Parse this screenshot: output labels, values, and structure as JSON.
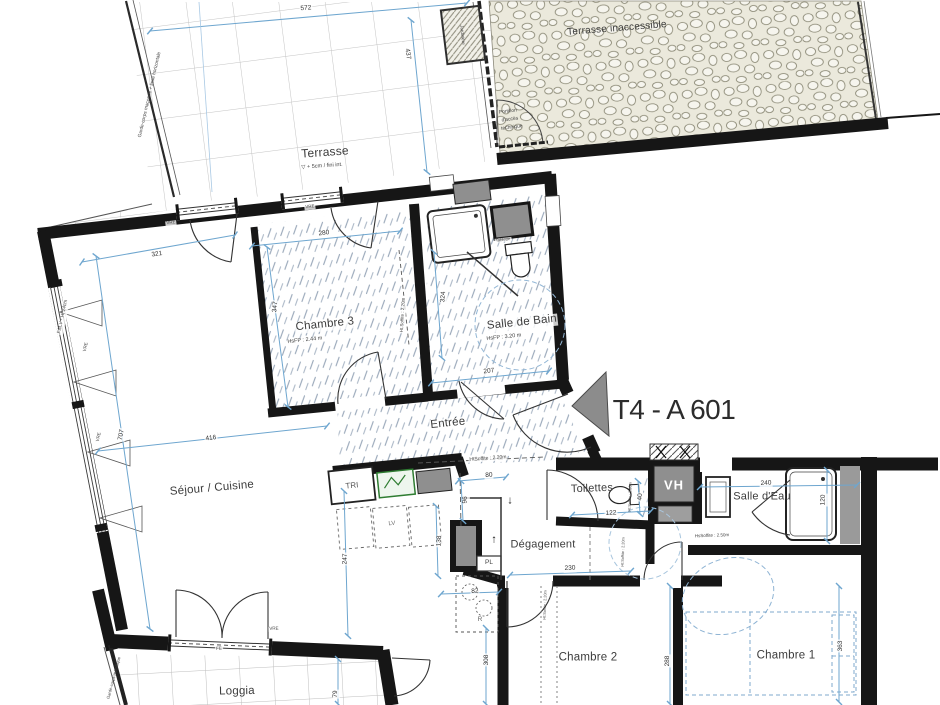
{
  "unit": {
    "label": "T4 - A 601"
  },
  "rooms": {
    "terrasse": {
      "name": "Terrasse",
      "note": "▽ + 5cm / fini int."
    },
    "terrasse_inaccessible": {
      "name": "Terrasse inaccessible"
    },
    "chambre3": {
      "name": "Chambre 3",
      "height_note": "HsFP : 2.44 m"
    },
    "salle_de_bain": {
      "name": "Salle de Bain",
      "height_note": "HsFP : 3.20 m"
    },
    "entree": {
      "name": "Entrée"
    },
    "sejour": {
      "name": "Séjour / Cuisine"
    },
    "toilettes": {
      "name": "Toilettes"
    },
    "salle_eau": {
      "name": "Salle d'Eau"
    },
    "degagement": {
      "name": "Dégagement"
    },
    "chambre2": {
      "name": "Chambre 2"
    },
    "chambre1": {
      "name": "Chambre 1"
    },
    "loggia": {
      "name": "Loggia"
    }
  },
  "annotations": {
    "garde_corps_terrasse": "Garde-corps maçonné + lisse horizontale",
    "garde_corps_loggia": "Garde-corps métallique",
    "jardiniere": "Jardinière",
    "portillon_l1": "Portillon",
    "portillon_l2": "d'accès",
    "portillon_l3": "technique",
    "fmv": "F.M.V - Ht 24cm",
    "tablette": "Tablette",
    "vre": "VRE",
    "fe": "FE",
    "tri": "TRI",
    "vh": "VH",
    "pl": "PL",
    "r": "R",
    "lv": "LV",
    "arrow_up": "↑",
    "arrow_down": "↓",
    "soffite_entree": "HtSoffite : 2.20m",
    "soffite_chambre3": "Ht.Soffite : 2.20m",
    "soffite_toilettes": "Ht:Soffite : 2.20m",
    "soffite_degagement": "Ht:Soffite : 2.20m",
    "soffite_chambre2": "Ht:Soffite : 2.20m",
    "soffite_sde": "HsSoffite : 2.50m"
  },
  "dims": {
    "d572": "572",
    "d437": "437",
    "d280": "280",
    "d347": "347",
    "d321": "321",
    "d324": "324",
    "d207": "207",
    "d416": "416",
    "d707": "707",
    "d247": "247",
    "d80": "80",
    "d96": "96",
    "d138": "138",
    "d122": "122",
    "d40": "40",
    "d240": "240",
    "d120": "120",
    "d230": "230",
    "d82": "82",
    "d308": "308",
    "d288": "288",
    "d363": "363",
    "d79": "79"
  },
  "colors": {
    "wall": "#161616",
    "dim_line": "#6ea6cf",
    "hatch": "#97a6b8",
    "gravel_bg": "#ebe9dc",
    "fixture_gray": "#8f8f8f",
    "accent_green": "#2f7d32"
  }
}
